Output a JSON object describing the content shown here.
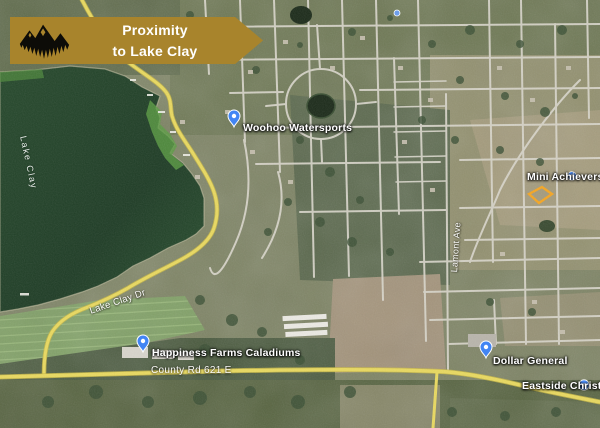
{
  "banner": {
    "line1": "Proximity",
    "line2": "to Lake Clay",
    "background_color": "#a8842c",
    "text_color": "#ffffff",
    "logo_icon": "mountains-trees-silhouette"
  },
  "map": {
    "imagery_type": "satellite",
    "water_label": "Lake Clay",
    "road_labels": {
      "shore_road": "Lake Clay Dr",
      "county_road": "County Rd 621 E",
      "north_south_ave": "Lamont Ave"
    },
    "pois": {
      "woohoo_watersports": {
        "name": "Woohoo Watersports",
        "icon": "blue-map-pin"
      },
      "mini_achievers": {
        "name": "Mini Achievers Day",
        "icon": "blue-circle-poi"
      },
      "happiness_farms": {
        "name": "Happiness Farms Caladiums",
        "icon": "blue-map-pin"
      },
      "dollar_general": {
        "name": "Dollar General",
        "icon": "blue-map-pin"
      },
      "eastside_christian": {
        "name": "Eastside Christian",
        "icon": "blue-circle-poi"
      }
    },
    "highlight_parcel": {
      "outline_color": "#f5a623",
      "fill": "none"
    },
    "colors": {
      "road_yellow": "#e9d95f",
      "street_white": "#d9d6cb",
      "lake_green": "#24462a",
      "pin_blue": "#4285f4"
    }
  }
}
